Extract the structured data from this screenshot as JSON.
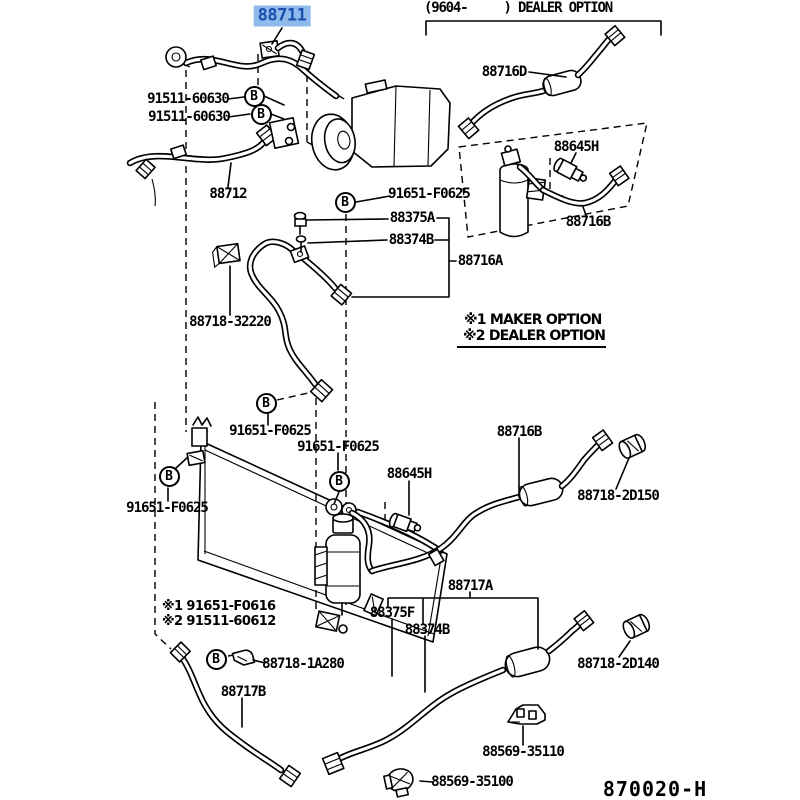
{
  "colors": {
    "highlight_bg": "#8FBBEB",
    "highlight_text": "#1A4FAE",
    "line": "#000000",
    "background": "#FFFFFF"
  },
  "symbols": {
    "bolt": "B"
  },
  "header": {
    "dealer_section": "(9604-     ) DEALER OPTION"
  },
  "notes": {
    "maker_option": "※1 MAKER OPTION",
    "dealer_option": "※2 DEALER OPTION",
    "opt1": "※1 91651-F0616",
    "opt2": "※2 91511-60612"
  },
  "doc_code": "870020-H",
  "labels": {
    "l88711": "88711",
    "l88716D": "88716D",
    "l88645H_1": "88645H",
    "l88716B_1": "88716B",
    "l91511_60630_1": "91511-60630",
    "l91511_60630_2": "91511-60630",
    "l88712": "88712",
    "l91651_F0625_1": "91651-F0625",
    "l88375A": "88375A",
    "l88374B_1": "88374B",
    "l88716A": "88716A",
    "l88718_32220": "88718-32220",
    "l91651_F0625_2": "91651-F0625",
    "l91651_F0625_3": "91651-F0625",
    "l88716B_2": "88716B",
    "l88645H_2": "88645H",
    "l88718_2D150": "88718-2D150",
    "l91651_F0625_4": "91651-F0625",
    "l88717A": "88717A",
    "l88375F": "88375F",
    "l88374B_2": "88374B",
    "l88718_1A280": "88718-1A280",
    "l88717B": "88717B",
    "l88718_2D140": "88718-2D140",
    "l88569_35110": "88569-35110",
    "l88569_35100": "88569-35100"
  }
}
